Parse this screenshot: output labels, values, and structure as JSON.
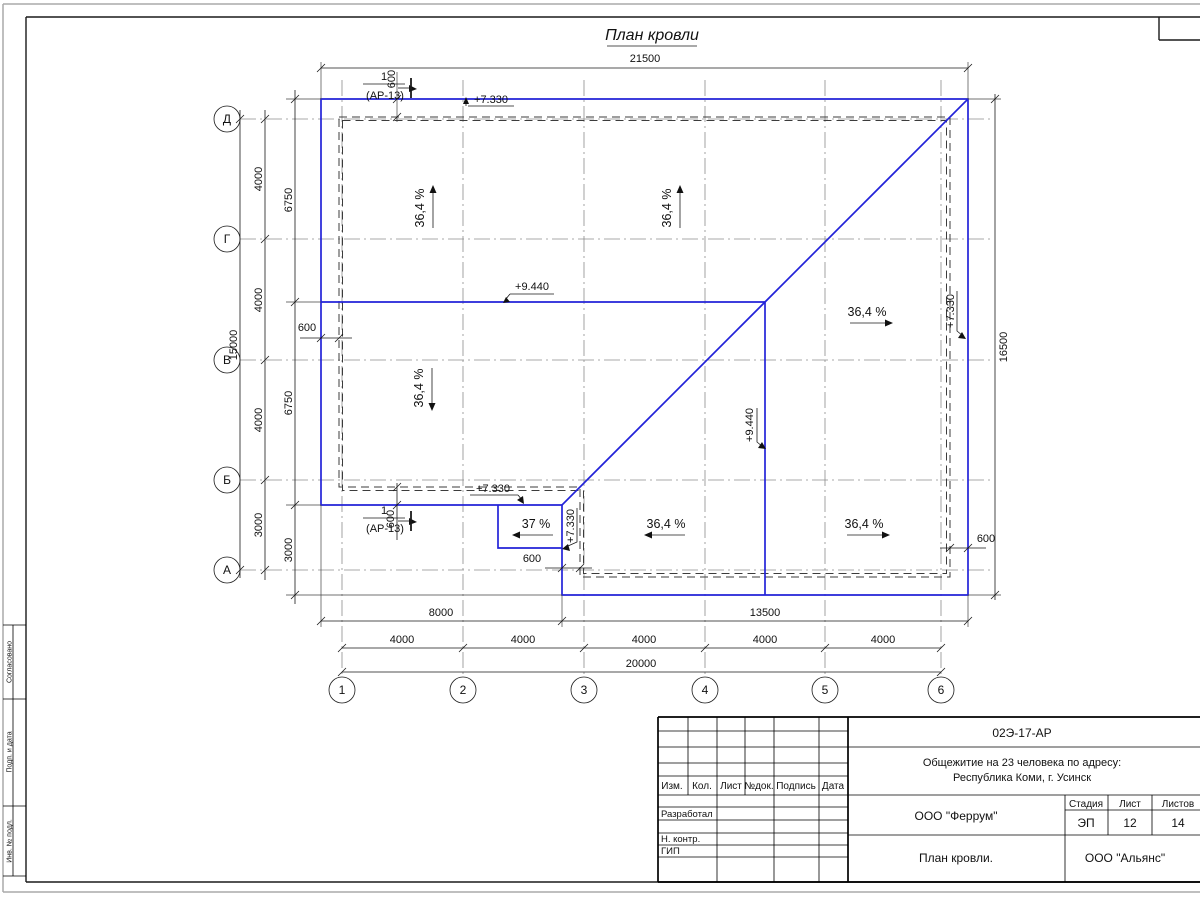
{
  "page": {
    "title": "План кровли"
  },
  "axes": {
    "cols": [
      "1",
      "2",
      "3",
      "4",
      "5",
      "6"
    ],
    "rows": [
      "Д",
      "Г",
      "В",
      "Б",
      "А"
    ]
  },
  "dims": {
    "top_total": "21500",
    "left_axis": [
      "4000",
      "4000",
      "4000",
      "3000"
    ],
    "left_axis_total": "15000",
    "left_inner": [
      "6750",
      "6750",
      "3000"
    ],
    "right_total": "16500",
    "bottom_split": [
      "8000",
      "13500"
    ],
    "bottom_bays": [
      "4000",
      "4000",
      "4000",
      "4000",
      "4000"
    ],
    "bottom_total": "20000",
    "offset": "600"
  },
  "marks": {
    "eaves": "+7.330",
    "ridge": "+9.440"
  },
  "slopes": {
    "main": "36,4 %",
    "low": "37 %"
  },
  "section": {
    "num": "1",
    "ref": "(АР-13)"
  },
  "titleblock": {
    "doc_number": "02Э-17-АР",
    "project_line1": "Общежитие на 23 человека по адресу:",
    "project_line2": "Республика Коми, г. Усинск",
    "org": "ООО \"Феррум\"",
    "stage_label": "Стадия",
    "sheet_label": "Лист",
    "sheets_label": "Листов",
    "stage": "ЭП",
    "sheet": "12",
    "sheets": "14",
    "drawing_title": "План кровли.",
    "org2": "ООО \"Альянс\"",
    "header_cells": [
      "Изм.",
      "Кол.",
      "Лист",
      "№док.",
      "Подпись",
      "Дата"
    ],
    "roles": [
      "Разработал",
      "Н. контр.",
      "ГИП"
    ]
  },
  "sidestrip": {
    "labels": [
      "Согласовано",
      "Подп. и дата",
      "Инв. № подл."
    ]
  }
}
